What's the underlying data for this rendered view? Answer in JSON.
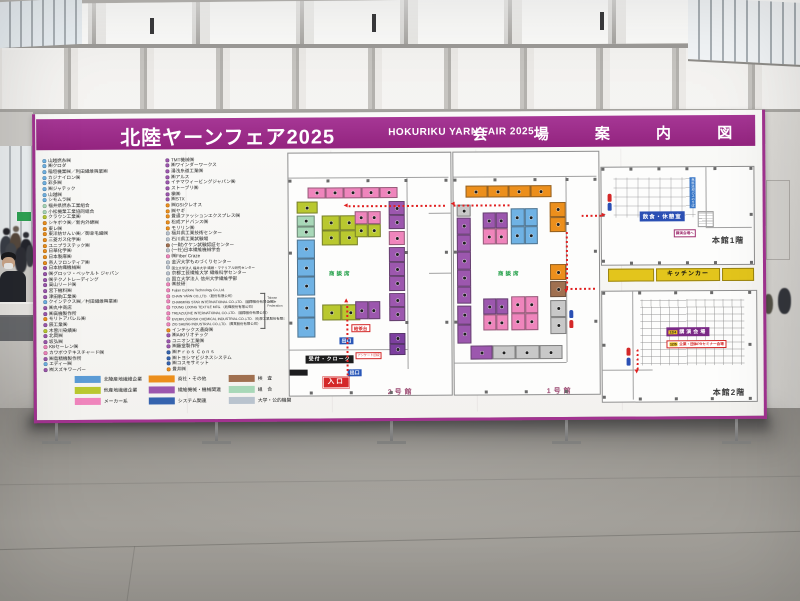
{
  "header": {
    "title_jp": "北陸ヤーンフェア2025",
    "title_en": "HOKURIKU YARN FAIR 2025",
    "title_right": "会 場 案 内 図"
  },
  "exhibitors": {
    "col1": [
      {
        "c": "B",
        "t": "山越撚糸㈱"
      },
      {
        "c": "B",
        "t": "㈱クロダ"
      },
      {
        "c": "B",
        "t": "稲垣機業㈱／利田繊維興業㈱"
      },
      {
        "c": "B",
        "t": "カジナイロン㈱"
      },
      {
        "c": "B",
        "t": "彩多㈱"
      },
      {
        "c": "B",
        "t": "㈱ジャテック"
      },
      {
        "c": "B",
        "t": "山越㈱"
      },
      {
        "c": "B",
        "t": "シモムラ㈱"
      },
      {
        "c": "LG",
        "t": "福井県撚糸工業組合"
      },
      {
        "c": "LG",
        "t": "小松機業工業協同組合"
      },
      {
        "c": "G",
        "t": "クラウン工業㈱"
      },
      {
        "c": "O",
        "t": "シキボウ㈱／新内外綿㈱"
      },
      {
        "c": "O",
        "t": "東レ㈱"
      },
      {
        "c": "O",
        "t": "東洋紡せんい㈱／御幸毛織㈱"
      },
      {
        "c": "O",
        "t": "三菱ガス化学㈱"
      },
      {
        "c": "O",
        "t": "ユニプラステック㈱"
      },
      {
        "c": "O",
        "t": "日華化学㈱"
      },
      {
        "c": "O",
        "t": "日本製麻㈱"
      },
      {
        "c": "O",
        "t": "帝人フロンティア㈱"
      },
      {
        "c": "PU",
        "t": "日本紡織機械㈱"
      },
      {
        "c": "PU",
        "t": "㈱グロッツ・ベッケルト ジャパン"
      },
      {
        "c": "PU",
        "t": "㈱テクノトレーディング"
      },
      {
        "c": "PU",
        "t": "高山リード㈱"
      },
      {
        "c": "PU",
        "t": "宮下機料㈱"
      },
      {
        "c": "PU",
        "t": "津田駒工業㈱"
      },
      {
        "c": "B",
        "t": "クインテクス㈱／村田繊維興業㈱"
      },
      {
        "c": "PU",
        "t": "㈱丸中商店"
      },
      {
        "c": "PU",
        "t": "㈱高機製作所"
      },
      {
        "c": "O",
        "t": "モリトアパレル㈱"
      },
      {
        "c": "PU",
        "t": "辰工業㈱"
      },
      {
        "c": "G",
        "t": "木曽川染績㈱"
      },
      {
        "c": "PU",
        "t": "北岡㈱"
      },
      {
        "c": "PU",
        "t": "坂弘㈱"
      },
      {
        "c": "P",
        "t": "KBセーレン㈱"
      },
      {
        "c": "P",
        "t": "カワボウテキスチャード㈱"
      },
      {
        "c": "PU",
        "t": "㈱島精機製作所"
      },
      {
        "c": "B",
        "t": "エディー㈱"
      },
      {
        "c": "PU",
        "t": "㈲スズキワーパー"
      }
    ],
    "col2": [
      {
        "c": "PU",
        "t": "TMT機械㈱"
      },
      {
        "c": "PU",
        "t": "㈱ワインダーワークス"
      },
      {
        "c": "PU",
        "t": "湯浅糸道工業㈱"
      },
      {
        "c": "PU",
        "t": "㈱アルス"
      },
      {
        "c": "PU",
        "t": "イテマウィービングジャパン㈱"
      },
      {
        "c": "PU",
        "t": "ストーブリ㈱"
      },
      {
        "c": "PU",
        "t": "槇㈱"
      },
      {
        "c": "PU",
        "t": "㈱STX"
      },
      {
        "c": "O",
        "t": "㈱GSIクレオス"
      },
      {
        "c": "O",
        "t": "㈱ヤギ"
      },
      {
        "c": "O",
        "t": "豊通ファッションエクスプレス㈱"
      },
      {
        "c": "O",
        "t": "松成アドバンス㈱"
      },
      {
        "c": "O",
        "t": "モリリン㈱"
      },
      {
        "c": "GY2",
        "t": "福井県工業技術センター"
      },
      {
        "c": "GY2",
        "t": "石川県工業試験場"
      },
      {
        "c": "BR",
        "t": "(一財)ケケン試験認証センター"
      },
      {
        "c": "GY2",
        "t": "(一社)日本繊維機械学会"
      },
      {
        "c": "P",
        "t": "㈱Fiber Craze"
      },
      {
        "c": "GY2",
        "t": "金沢大学ものづくりセンター"
      },
      {
        "c": "GY2",
        "t": "国立大学法人 福井大学 繊維・マテリアル研究センター"
      },
      {
        "c": "GY2",
        "t": "京都工芸繊維大学 繊維科学センター"
      },
      {
        "c": "GY2",
        "t": "国立大学法人 信州大学繊維学部"
      },
      {
        "c": "P",
        "t": "㈱技研"
      },
      {
        "c": "P",
        "t": "Fujian Cyclone Technology Co.,Ltd."
      },
      {
        "c": "P",
        "t": "CHAIN YARN CO.,LTD.（股份有限公司）"
      },
      {
        "c": "P",
        "t": "CHARMING STAR INTERNATIONAL CO.,LTD.（國際股份有限公司）"
      },
      {
        "c": "P",
        "t": "TOUNG LOONG TEXTILE MFG.（紡織股份有限公司）"
      },
      {
        "c": "P",
        "t": "TREAZULINE INTERNATIONAL CO.,LTD.（國際股份有限公司）"
      },
      {
        "c": "P",
        "t": "EVERFLOURISH CHEMICAL INDUSTRIAL CO.,LTD.（化學工業股份有限公司）"
      },
      {
        "c": "P",
        "t": "ZIG SHENG INDUSTRIAL CO.,LTD.（實業股份有限公司）"
      },
      {
        "c": "O",
        "t": "インテックス通商㈱"
      },
      {
        "c": "PU",
        "t": "㈱AIKIリオテック"
      },
      {
        "c": "PU",
        "t": "ユニオン工業㈱"
      },
      {
        "c": "PU",
        "t": "㈱藤堂製作所"
      },
      {
        "c": "DB",
        "t": "㈱Ｐｒｏｓ Ｃｏｎｓ"
      },
      {
        "c": "DB",
        "t": "㈱トヨシマビジネスシステム"
      },
      {
        "c": "DB",
        "t": "㈱コスモサミット"
      },
      {
        "c": "O",
        "t": "豊井㈱"
      }
    ],
    "taiwan_label": "Taiwan Textile Federation"
  },
  "legend": {
    "items": [
      {
        "c": "#5b9bd5",
        "t": "北陸産地繊維企業"
      },
      {
        "c": "#b9c82f",
        "t": "他産地繊維企業"
      },
      {
        "c": "#ef85bc",
        "t": "メーカー系"
      },
      {
        "c": "#ec8f1c",
        "t": "商社・その他"
      },
      {
        "c": "#9c57ae",
        "t": "繊維機械・機械関連"
      },
      {
        "c": "#3563ae",
        "t": "システム関連"
      },
      {
        "c": "#a07050",
        "t": "検　査"
      },
      {
        "c": "#a8d8b8",
        "t": "組　合"
      },
      {
        "c": "#b9c3ce",
        "t": "大学・公的機関"
      }
    ]
  },
  "palette": {
    "B": "#6fb2e4",
    "G": "#b9c82f",
    "LG": "#a8d8b8",
    "P": "#ef85bc",
    "O": "#ec8f1c",
    "PU": "#9c57ae",
    "V": "#7c3f9e",
    "DB": "#3563ae",
    "BR": "#a07050",
    "GY": "#c8c8c8",
    "GY2": "#b9c3ce"
  },
  "kitchen": {
    "label": "キッチンカー"
  },
  "maps": {
    "hall2": {
      "name": "2号館",
      "signs": {
        "shodan": "商談席",
        "kyucha": "給茶台",
        "exit1": "出口",
        "reception": "受付・クローク",
        "survey": "アンケート回収",
        "exit2": "出口",
        "entrance": "入口"
      },
      "booths": [
        {
          "x": 19,
          "y": 34,
          "w": 90,
          "h": 11,
          "c": "P",
          "n": 5
        },
        {
          "x": 8,
          "y": 48,
          "w": 21,
          "h": 12,
          "c": "G",
          "n": 1
        },
        {
          "x": 8,
          "y": 62,
          "w": 18,
          "h": 22,
          "c": "LG",
          "n": 2,
          "d": "c"
        },
        {
          "x": 8,
          "y": 86,
          "w": 18,
          "h": 56,
          "c": "B",
          "n": 3,
          "d": "c"
        },
        {
          "x": 8,
          "y": 144,
          "w": 18,
          "h": 40,
          "c": "B",
          "n": 2,
          "d": "c"
        },
        {
          "x": 33,
          "y": 62,
          "w": 36,
          "h": 15,
          "c": "G",
          "n": 2
        },
        {
          "x": 33,
          "y": 77,
          "w": 36,
          "h": 15,
          "c": "G",
          "n": 2
        },
        {
          "x": 66,
          "y": 58,
          "w": 26,
          "h": 13,
          "c": "P",
          "n": 2
        },
        {
          "x": 66,
          "y": 71,
          "w": 26,
          "h": 13,
          "c": "G",
          "n": 2
        },
        {
          "x": 33,
          "y": 151,
          "w": 38,
          "h": 16,
          "c": "G",
          "n": 2
        },
        {
          "x": 66,
          "y": 148,
          "w": 25,
          "h": 18,
          "c": "PU",
          "n": 2
        },
        {
          "x": 100,
          "y": 48,
          "w": 16,
          "h": 28,
          "c": "PU",
          "n": 2,
          "d": "c"
        },
        {
          "x": 100,
          "y": 78,
          "w": 16,
          "h": 14,
          "c": "P",
          "n": 1
        },
        {
          "x": 100,
          "y": 94,
          "w": 16,
          "h": 44,
          "c": "PU",
          "n": 3,
          "d": "c"
        },
        {
          "x": 100,
          "y": 140,
          "w": 16,
          "h": 28,
          "c": "PU",
          "n": 2,
          "d": "c"
        },
        {
          "x": 100,
          "y": 180,
          "w": 16,
          "h": 22,
          "c": "V",
          "n": 2,
          "d": "c"
        }
      ],
      "cols": [
        [
          0,
          26
        ],
        [
          38,
          26
        ],
        [
          78,
          26
        ],
        [
          116,
          26
        ],
        [
          156,
          26
        ],
        [
          0,
          98
        ],
        [
          0,
          168
        ],
        [
          116,
          98
        ],
        [
          116,
          168
        ],
        [
          156,
          98
        ],
        [
          156,
          168
        ],
        [
          20,
          238
        ],
        [
          60,
          238
        ],
        [
          100,
          238
        ]
      ],
      "lines": [
        {
          "x": 0,
          "y": 24,
          "w": 160,
          "h": 1
        },
        {
          "x": 118,
          "y": 24,
          "w": 1,
          "h": 192
        },
        {
          "x": 0,
          "y": 196,
          "w": 118,
          "h": 1
        },
        {
          "x": 140,
          "y": 60,
          "w": 22,
          "h": 1
        },
        {
          "x": 140,
          "y": 120,
          "w": 22,
          "h": 1
        }
      ],
      "paths": [
        {
          "o": "h",
          "x": 60,
          "y": 52,
          "len": 98
        },
        {
          "o": "v",
          "x": 57,
          "y": 150,
          "len": 72
        }
      ],
      "arrows": [
        {
          "d": "l",
          "x": 55,
          "y": 50
        },
        {
          "d": "u",
          "x": 55,
          "y": 145
        }
      ]
    },
    "hall1": {
      "name": "1号館",
      "signs": {
        "shodan": "商談席"
      },
      "booths": [
        {
          "x": 12,
          "y": 33,
          "w": 86,
          "h": 12,
          "c": "O",
          "n": 4
        },
        {
          "x": 3,
          "y": 52,
          "w": 14,
          "h": 12,
          "c": "GY",
          "n": 1
        },
        {
          "x": 3,
          "y": 65,
          "w": 14,
          "h": 86,
          "c": "PU",
          "n": 5,
          "d": "c"
        },
        {
          "x": 3,
          "y": 153,
          "w": 14,
          "h": 38,
          "c": "PU",
          "n": 2,
          "d": "c"
        },
        {
          "x": 29,
          "y": 60,
          "w": 25,
          "h": 16,
          "c": "PU",
          "n": 2
        },
        {
          "x": 29,
          "y": 76,
          "w": 25,
          "h": 16,
          "c": "P",
          "n": 2
        },
        {
          "x": 57,
          "y": 56,
          "w": 27,
          "h": 18,
          "c": "B",
          "n": 2
        },
        {
          "x": 57,
          "y": 74,
          "w": 27,
          "h": 18,
          "c": "B",
          "n": 2
        },
        {
          "x": 96,
          "y": 50,
          "w": 16,
          "h": 30,
          "c": "O",
          "n": 2,
          "d": "c"
        },
        {
          "x": 96,
          "y": 112,
          "w": 16,
          "h": 16,
          "c": "O",
          "n": 1
        },
        {
          "x": 96,
          "y": 129,
          "w": 16,
          "h": 16,
          "c": "BR",
          "n": 1
        },
        {
          "x": 29,
          "y": 146,
          "w": 25,
          "h": 16,
          "c": "PU",
          "n": 2
        },
        {
          "x": 29,
          "y": 162,
          "w": 25,
          "h": 16,
          "c": "P",
          "n": 2
        },
        {
          "x": 57,
          "y": 144,
          "w": 27,
          "h": 17,
          "c": "P",
          "n": 2
        },
        {
          "x": 57,
          "y": 161,
          "w": 27,
          "h": 17,
          "c": "P",
          "n": 2
        },
        {
          "x": 96,
          "y": 148,
          "w": 16,
          "h": 34,
          "c": "GY",
          "n": 2,
          "d": "c"
        },
        {
          "x": 16,
          "y": 193,
          "w": 22,
          "h": 14,
          "c": "PU",
          "n": 1
        },
        {
          "x": 38,
          "y": 193,
          "w": 70,
          "h": 14,
          "c": "GY",
          "n": 3
        }
      ],
      "cols": [
        [
          0,
          26
        ],
        [
          40,
          26
        ],
        [
          80,
          26
        ],
        [
          112,
          26
        ],
        [
          140,
          26
        ],
        [
          0,
          98
        ],
        [
          0,
          168
        ],
        [
          112,
          70
        ],
        [
          140,
          98
        ],
        [
          140,
          168
        ],
        [
          30,
          238
        ],
        [
          70,
          238
        ],
        [
          110,
          238
        ]
      ],
      "lines": [
        {
          "x": 0,
          "y": 24,
          "w": 143,
          "h": 1
        },
        {
          "x": 112,
          "y": 24,
          "w": 1,
          "h": 186
        },
        {
          "x": 0,
          "y": 210,
          "w": 112,
          "h": 1
        }
      ],
      "paths": [
        {
          "o": "h",
          "x": 0,
          "y": 52,
          "len": 56
        },
        {
          "o": "v",
          "x": 112,
          "y": 80,
          "len": 56
        },
        {
          "o": "h",
          "x": 112,
          "y": 136,
          "len": 31
        }
      ],
      "arrows": [
        {
          "d": "l",
          "x": -3,
          "y": 49
        },
        {
          "d": "dn",
          "x": 110,
          "y": 137
        }
      ]
    },
    "main1f": {
      "name": "本館1階",
      "signs": {
        "rest": "飲食・休憩室",
        "bus": "無料送迎バスのりば",
        "to_lecture": "講演会場へ"
      },
      "booths": [],
      "cols": [
        [
          0,
          0
        ],
        [
          28,
          0
        ],
        [
          56,
          0
        ],
        [
          84,
          0
        ],
        [
          112,
          0
        ],
        [
          148,
          0
        ],
        [
          0,
          46
        ],
        [
          0,
          92
        ],
        [
          28,
          94
        ],
        [
          56,
          94
        ],
        [
          84,
          94
        ],
        [
          112,
          94
        ],
        [
          148,
          46
        ],
        [
          148,
          94
        ]
      ],
      "lines": [
        {
          "x": 104,
          "y": 0,
          "w": 1,
          "h": 60
        },
        {
          "x": 104,
          "y": 60,
          "w": 46,
          "h": 1
        }
      ],
      "paths": [
        {
          "o": "h",
          "x": -20,
          "y": 47,
          "len": 20
        }
      ],
      "arrows": [
        {
          "d": "r",
          "x": 0,
          "y": 45
        }
      ]
    },
    "main2f": {
      "name": "本館2階",
      "signs": {
        "lecture": "講演会場",
        "lecture_date": "12/4",
        "seminar": "企業・団体PRセミナー会場",
        "seminar_date": "12/5"
      },
      "booths": [],
      "cols": [
        [
          0,
          0
        ],
        [
          36,
          0
        ],
        [
          72,
          0
        ],
        [
          108,
          0
        ],
        [
          146,
          0
        ],
        [
          0,
          52
        ],
        [
          0,
          104
        ],
        [
          36,
          106
        ],
        [
          72,
          106
        ],
        [
          108,
          106
        ],
        [
          146,
          52
        ],
        [
          146,
          106
        ]
      ],
      "lines": [
        {
          "x": 30,
          "y": 0,
          "w": 1,
          "h": 108
        },
        {
          "x": 0,
          "y": 78,
          "w": 30,
          "h": 1
        },
        {
          "x": 30,
          "y": 78,
          "w": 20,
          "h": 1
        }
      ],
      "paths": [
        {
          "o": "v",
          "x": 34,
          "y": 56,
          "len": 22
        }
      ],
      "arrows": [
        {
          "d": "dn",
          "x": 32,
          "y": 78
        }
      ]
    }
  }
}
